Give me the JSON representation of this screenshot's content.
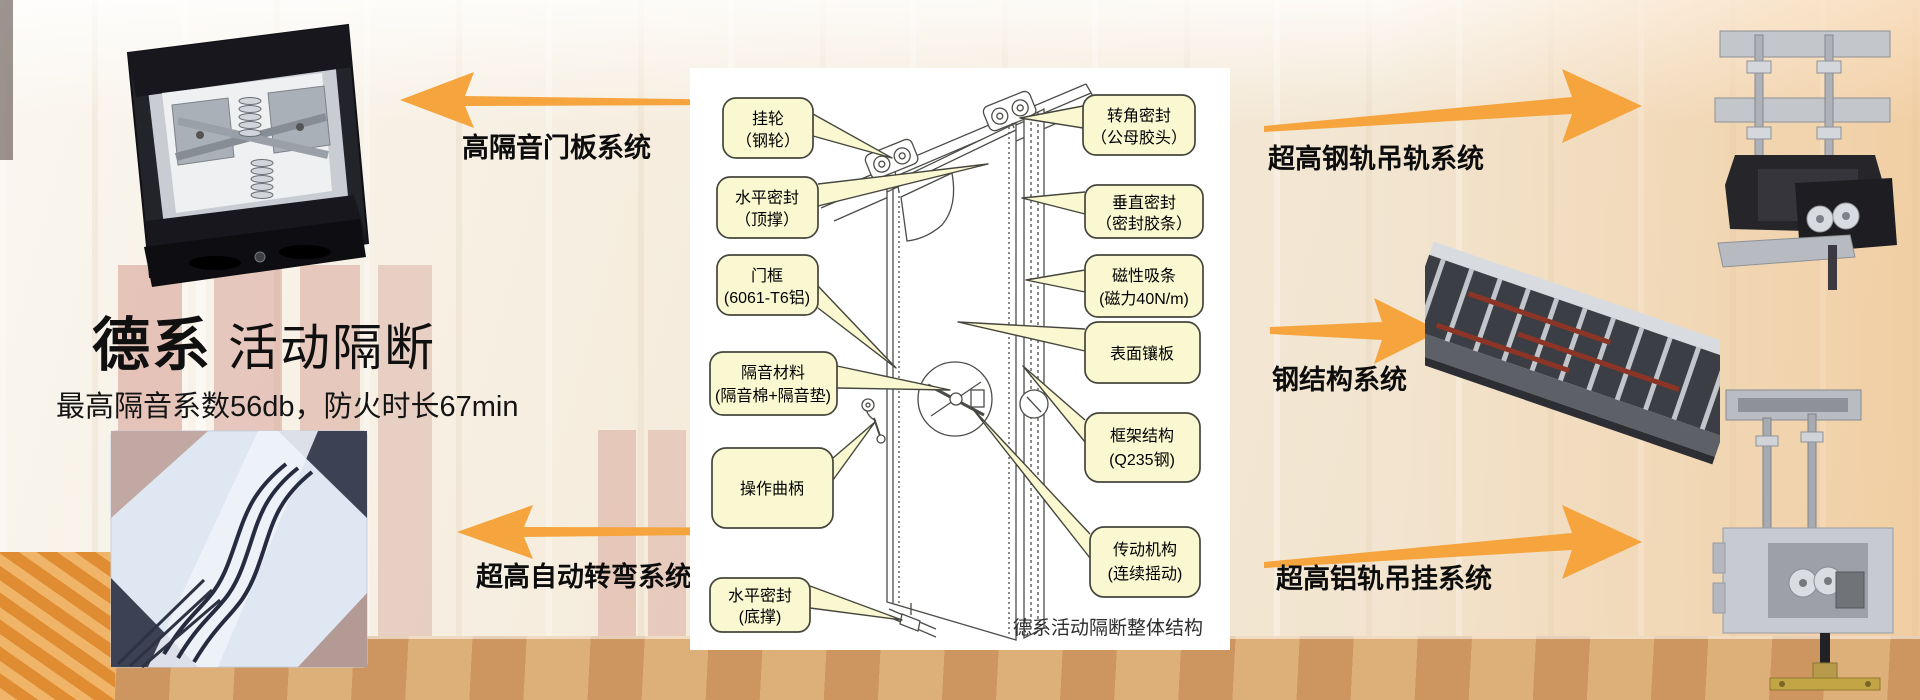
{
  "hero": {
    "title_bold": "德系",
    "title_rest": "活动隔断",
    "subtitle": "最高隔音系数56db，防火时长67min"
  },
  "labels": {
    "left_top": "高隔音门板系统",
    "left_bottom": "超高自动转弯系统",
    "right_top": "超高钢轨吊轨系统",
    "right_middle": "钢结构系统",
    "right_bottom": "超高铝轨吊挂系统"
  },
  "diagram": {
    "caption": "德系活动隔断整体结构",
    "callouts_left": [
      {
        "line1": "挂轮",
        "line2": "（钢轮）"
      },
      {
        "line1": "水平密封",
        "line2": "（顶撑）"
      },
      {
        "line1": "门框",
        "line2": "(6061-T6铝)"
      },
      {
        "line1": "隔音材料",
        "line2": "(隔音棉+隔音垫)"
      },
      {
        "line1": "操作曲柄",
        "line2": ""
      },
      {
        "line1": "水平密封",
        "line2": "(底撑)"
      }
    ],
    "callouts_right": [
      {
        "line1": "转角密封",
        "line2": "（公母胶头）"
      },
      {
        "line1": "垂直密封",
        "line2": "（密封胶条）"
      },
      {
        "line1": "磁性吸条",
        "line2": "(磁力40N/m)"
      },
      {
        "line1": "表面镶板",
        "line2": ""
      },
      {
        "line1": "框架结构",
        "line2": "(Q235钢)"
      },
      {
        "line1": "传动机构",
        "line2": "(连续摇动)"
      }
    ]
  },
  "colors": {
    "arrow": "#F5A43E",
    "callout_fill": "#FAF8D0",
    "callout_border": "#45453D"
  }
}
